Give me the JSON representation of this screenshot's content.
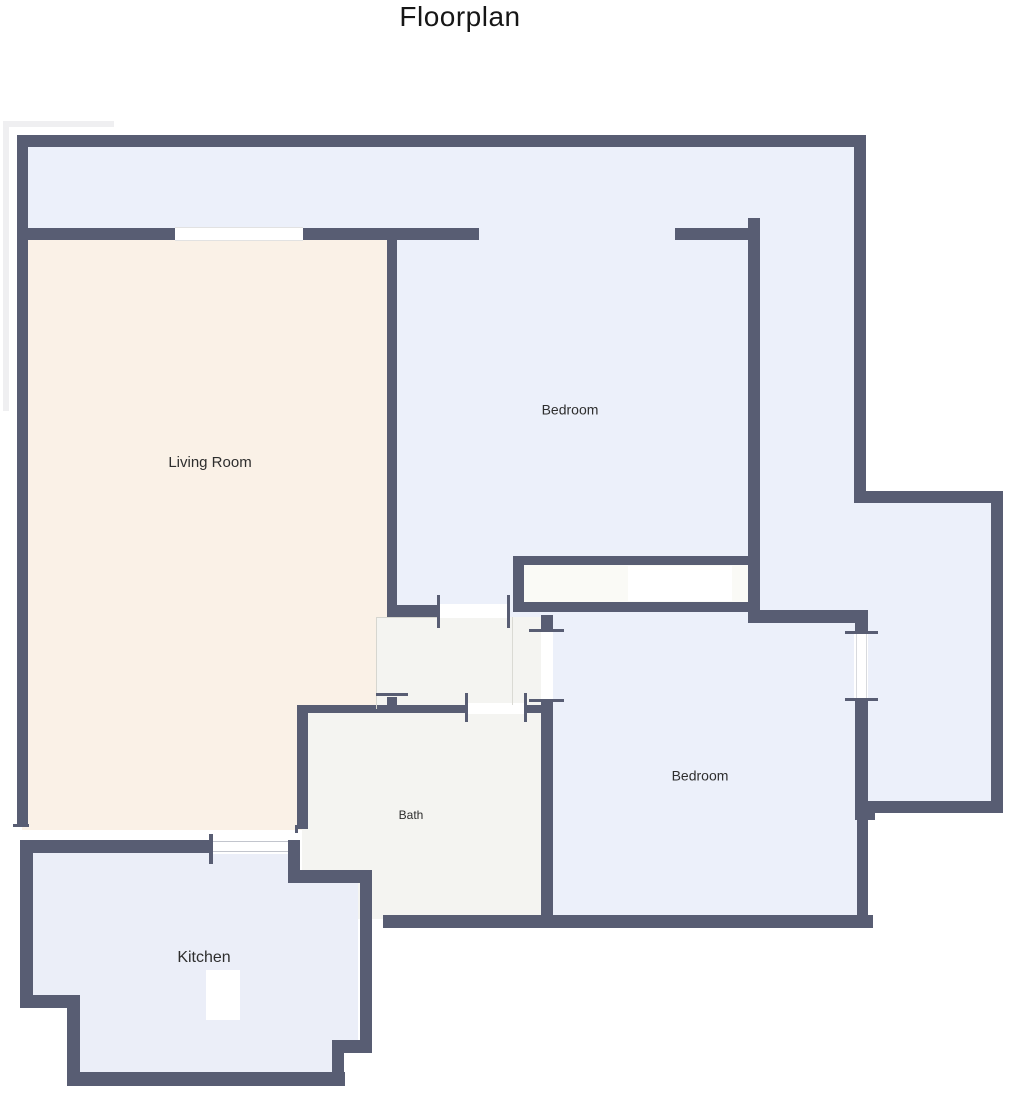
{
  "title": "Floorplan",
  "colors": {
    "wall": "#585d73",
    "blue": "#ecf0fa",
    "cream": "#faf1e7",
    "lavender": "#ebeef8",
    "bathgray": "#f4f4f1",
    "closet": "#fafaf6",
    "white": "#ffffff",
    "ghost": "#efeff1",
    "text": "#2e2e2e"
  },
  "rooms": [
    {
      "name": "entry-band-and-bedroom-top",
      "fill": "blue",
      "rect": [
        22,
        141,
        838,
        479
      ]
    },
    {
      "name": "annex-room",
      "fill": "blue",
      "rect": [
        858,
        497,
        140,
        310
      ]
    },
    {
      "name": "bedroom-bottom-floor",
      "fill": "blue",
      "rect": [
        548,
        615,
        315,
        306
      ]
    },
    {
      "name": "living-room-floor",
      "fill": "cream",
      "rect": [
        22,
        234,
        370,
        596
      ]
    },
    {
      "name": "hall-floor",
      "fill": "bathgray",
      "rect": [
        376,
        617,
        166,
        92
      ]
    },
    {
      "name": "bath-floor",
      "fill": "bathgray",
      "rect": [
        302,
        709,
        245,
        210
      ]
    },
    {
      "name": "closet-interior",
      "fill": "closet",
      "rect": [
        524,
        565,
        224,
        37
      ]
    },
    {
      "name": "closet-shelf",
      "fill": "white",
      "rect": [
        628,
        566,
        104,
        35
      ]
    },
    {
      "name": "kitchen-floor",
      "fill": "lavender",
      "polygon": [
        [
          26,
          846
        ],
        [
          291,
          846
        ],
        [
          291,
          878
        ],
        [
          358,
          878
        ],
        [
          358,
          1042
        ],
        [
          336,
          1042
        ],
        [
          336,
          1078
        ],
        [
          73,
          1078
        ],
        [
          73,
          1001
        ],
        [
          26,
          1001
        ]
      ]
    },
    {
      "name": "kitchen-island",
      "fill": "white",
      "rect": [
        206,
        970,
        34,
        50
      ]
    }
  ],
  "ghost_lines": [
    [
      3,
      121,
      111,
      6
    ],
    [
      3,
      121,
      6,
      290
    ]
  ],
  "walls": [
    [
      17,
      135,
      849,
      12
    ],
    [
      17,
      135,
      11,
      691
    ],
    [
      854,
      135,
      12,
      368
    ],
    [
      860,
      491,
      143,
      12
    ],
    [
      991,
      491,
      12,
      322
    ],
    [
      858,
      801,
      145,
      12
    ],
    [
      17,
      228,
      158,
      12
    ],
    [
      303,
      228,
      176,
      12
    ],
    [
      675,
      228,
      73,
      12
    ],
    [
      387,
      228,
      10,
      389
    ],
    [
      387,
      697,
      10,
      12
    ],
    [
      748,
      218,
      12,
      405
    ],
    [
      513,
      556,
      245,
      9
    ],
    [
      513,
      556,
      11,
      56
    ],
    [
      513,
      602,
      245,
      10
    ],
    [
      748,
      610,
      120,
      13
    ],
    [
      390,
      605,
      48,
      12
    ],
    [
      541,
      615,
      12,
      16
    ],
    [
      541,
      702,
      12,
      226
    ],
    [
      297,
      705,
      170,
      8
    ],
    [
      527,
      705,
      26,
      8
    ],
    [
      297,
      705,
      11,
      124
    ],
    [
      855,
      617,
      13,
      18
    ],
    [
      855,
      700,
      13,
      112
    ],
    [
      855,
      808,
      20,
      12
    ],
    [
      857,
      820,
      11,
      100
    ],
    [
      383,
      915,
      490,
      13
    ],
    [
      20,
      840,
      192,
      13
    ],
    [
      288,
      840,
      12,
      40
    ],
    [
      288,
      870,
      82,
      13
    ],
    [
      360,
      870,
      12,
      178
    ],
    [
      332,
      1040,
      40,
      13
    ],
    [
      332,
      1040,
      12,
      40
    ],
    [
      67,
      1072,
      278,
      14
    ],
    [
      67,
      995,
      13,
      91
    ],
    [
      20,
      995,
      58,
      13
    ],
    [
      20,
      840,
      13,
      168
    ]
  ],
  "openings": [
    {
      "name": "living-room-window",
      "rect": [
        175,
        227,
        128,
        14
      ]
    },
    {
      "name": "hall-door",
      "rect": [
        440,
        604,
        68,
        14
      ]
    },
    {
      "name": "bath-door",
      "rect": [
        467,
        703,
        58,
        11
      ]
    },
    {
      "name": "bedroom2-door",
      "rect": [
        541,
        631,
        12,
        70
      ]
    },
    {
      "name": "annex-window",
      "rect": [
        854,
        634,
        14,
        65
      ]
    },
    {
      "name": "kitchen-window",
      "rect": [
        212,
        839,
        76,
        15
      ]
    }
  ],
  "thin_lines": [
    {
      "rect": [
        376,
        617,
        1,
        92
      ],
      "color": "#d6d6d0"
    },
    {
      "rect": [
        376,
        617,
        64,
        1
      ],
      "color": "#d6d6d0"
    },
    {
      "rect": [
        512,
        617,
        1,
        88
      ],
      "color": "#dadad4"
    },
    {
      "rect": [
        175,
        227,
        128,
        1
      ],
      "color": "#e2e2e2"
    },
    {
      "rect": [
        175,
        240,
        128,
        1
      ],
      "color": "#e2e2e2"
    },
    {
      "rect": [
        212,
        841,
        76,
        1
      ],
      "color": "#c2c5cd"
    },
    {
      "rect": [
        212,
        851,
        76,
        1
      ],
      "color": "#c2c5cd"
    },
    {
      "rect": [
        856,
        634,
        1,
        65
      ],
      "color": "#d8dade"
    },
    {
      "rect": [
        866,
        634,
        1,
        65
      ],
      "color": "#d8dade"
    }
  ],
  "ticks": [
    [
      437,
      595,
      3,
      33
    ],
    [
      507,
      595,
      3,
      33
    ],
    [
      465,
      693,
      3,
      29
    ],
    [
      524,
      693,
      3,
      29
    ],
    [
      376,
      693,
      32,
      3
    ],
    [
      529,
      629,
      35,
      3
    ],
    [
      529,
      699,
      35,
      3
    ],
    [
      845,
      631,
      33,
      3
    ],
    [
      845,
      698,
      33,
      3
    ],
    [
      209,
      834,
      4,
      30
    ],
    [
      13,
      824,
      16,
      3
    ],
    [
      295,
      825,
      3,
      8
    ]
  ],
  "labels": [
    {
      "name": "living-room-label",
      "text": "Living Room",
      "x": 210,
      "y": 463,
      "size": 15
    },
    {
      "name": "bedroom-top-label",
      "text": "Bedroom",
      "x": 570,
      "y": 411,
      "size": 14
    },
    {
      "name": "bedroom-bottom-label",
      "text": "Bedroom",
      "x": 700,
      "y": 777,
      "size": 14
    },
    {
      "name": "bath-label",
      "text": "Bath",
      "x": 411,
      "y": 816,
      "size": 12
    },
    {
      "name": "kitchen-label",
      "text": "Kitchen",
      "x": 204,
      "y": 958,
      "size": 16
    }
  ]
}
